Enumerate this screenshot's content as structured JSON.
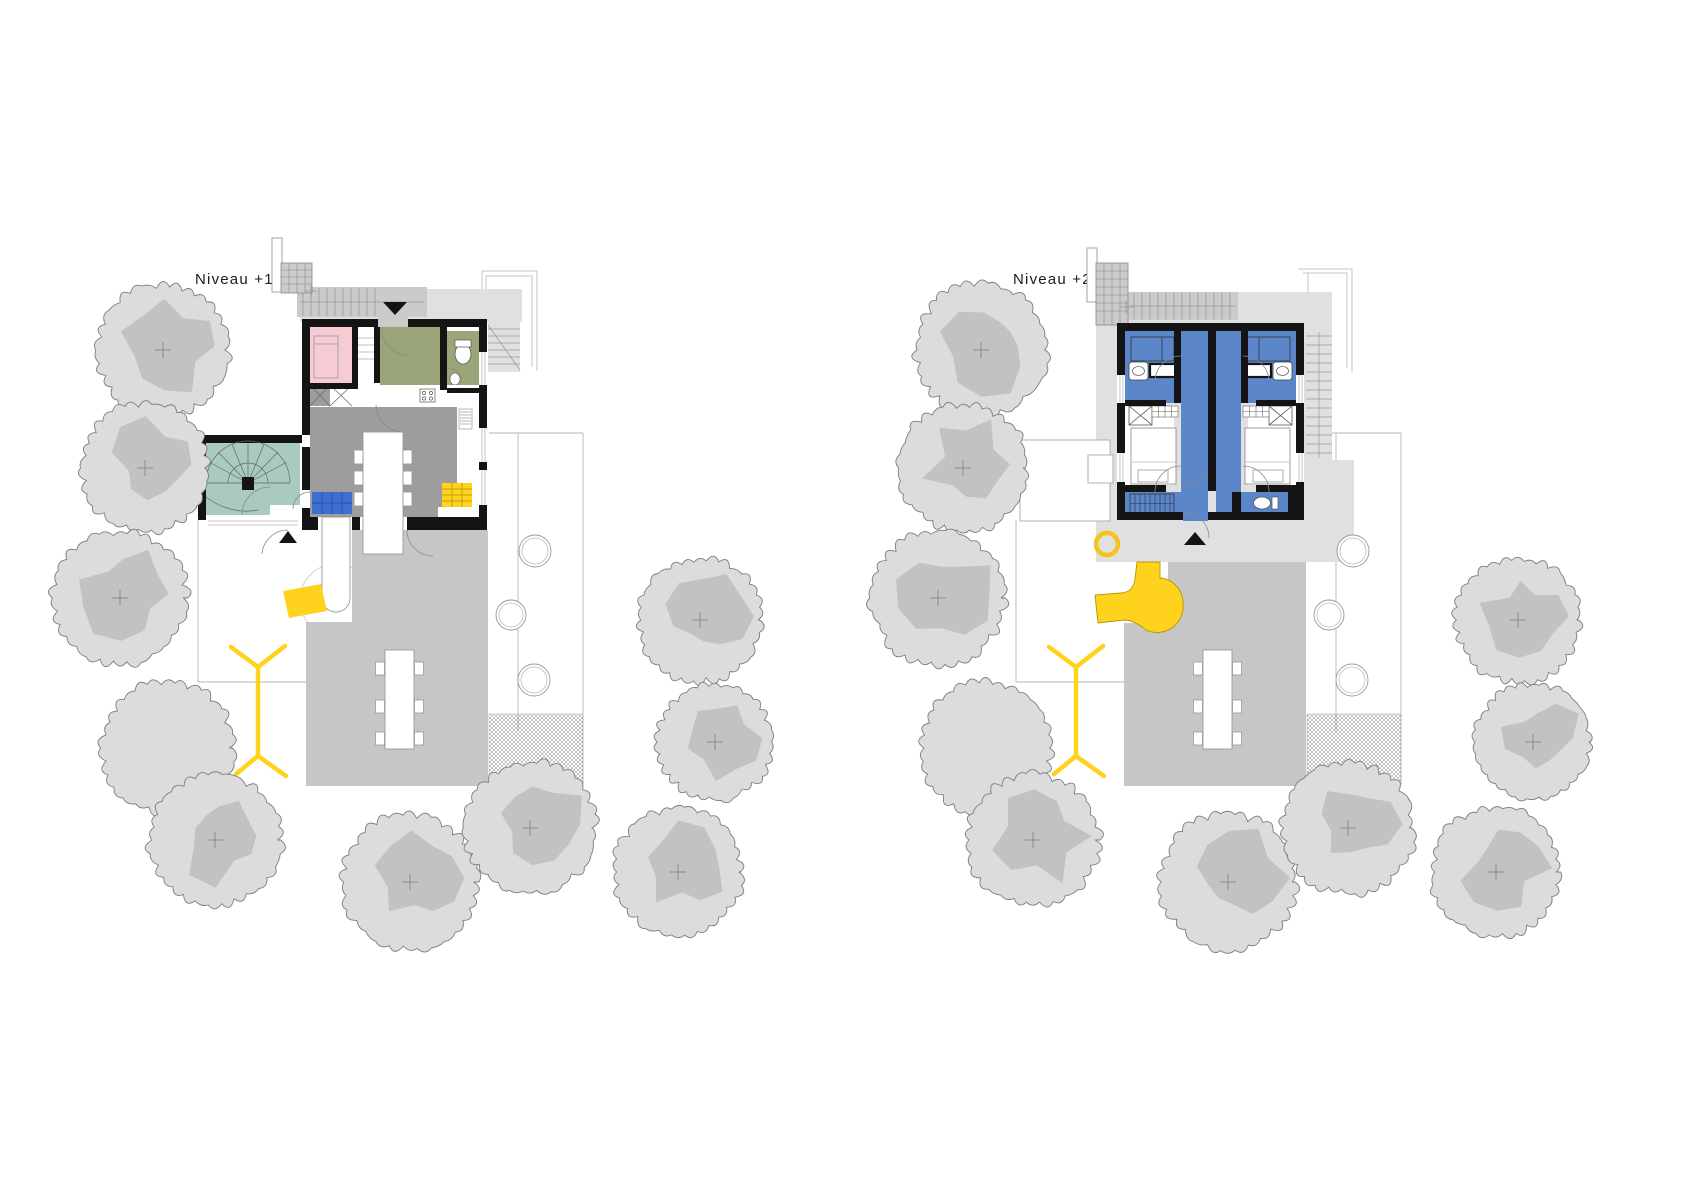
{
  "page": {
    "background": "#ffffff",
    "drawing_type": "architectural site plan, two levels side by side"
  },
  "plans": [
    {
      "label": "Niveau +1",
      "label_x": 195,
      "label_y": 284,
      "offset_x": 0
    },
    {
      "label": "Niveau +2",
      "label_x": 1013,
      "label_y": 284,
      "offset_x": 818
    }
  ],
  "palette": {
    "wall": "#141414",
    "terrace": "#c6c6c6",
    "deck": "#e0e0e1",
    "stair_band": "#cbcbcb",
    "tree_fill": "#dcdcdc",
    "tree_blob": "#c2c2c2",
    "tree_outline": "#7d7d7d",
    "accent_yellow": "#ffd21e",
    "accent_yellow_line": "#b99400",
    "room_pink": "#f6cbd3",
    "room_olive": "#9aa57a",
    "room_teal": "#a8cabf",
    "room_gray": "#9d9d9d",
    "sofa_blue": "#3e6ed2",
    "floor_blue": "#5b86c9"
  },
  "site": {
    "trees": [
      {
        "x": 163,
        "y": 350,
        "r": 66,
        "blob": true
      },
      {
        "x": 145,
        "y": 468,
        "r": 64,
        "blob": true
      },
      {
        "x": 120,
        "y": 598,
        "r": 67,
        "blob": true
      },
      {
        "x": 168,
        "y": 748,
        "r": 66,
        "blob": false
      },
      {
        "x": 215,
        "y": 840,
        "r": 66,
        "blob": true
      },
      {
        "x": 410,
        "y": 882,
        "r": 68,
        "blob": true
      },
      {
        "x": 530,
        "y": 828,
        "r": 66,
        "blob": true
      },
      {
        "x": 678,
        "y": 872,
        "r": 64,
        "blob": true
      },
      {
        "x": 700,
        "y": 620,
        "r": 62,
        "blob": true
      },
      {
        "x": 715,
        "y": 742,
        "r": 58,
        "blob": true
      }
    ],
    "stepping_stones": [
      {
        "x": 535,
        "y": 551,
        "r": 16
      },
      {
        "x": 511,
        "y": 615,
        "r": 15
      },
      {
        "x": 534,
        "y": 680,
        "r": 16
      }
    ],
    "gravel_patch": {
      "x": 489,
      "y": 714,
      "w": 94,
      "h": 70
    },
    "boundary_lines": [
      {
        "x1": 583,
        "y1": 433,
        "x2": 583,
        "y2": 784
      },
      {
        "x1": 489,
        "y1": 433,
        "x2": 583,
        "y2": 433
      },
      {
        "x1": 518,
        "y1": 433,
        "x2": 518,
        "y2": 731
      },
      {
        "x1": 198,
        "y1": 520,
        "x2": 198,
        "y2": 682
      },
      {
        "x1": 198,
        "y1": 682,
        "x2": 306,
        "y2": 682
      }
    ],
    "picnic_table": {
      "x": 385,
      "y": 650,
      "w": 29,
      "h": 99
    },
    "hammock": {
      "top_join": [
        258,
        667
      ],
      "bottom_join": [
        258,
        756
      ],
      "arms": [
        [
          231,
          647
        ],
        [
          285,
          646
        ],
        [
          236,
          774
        ],
        [
          286,
          776
        ]
      ]
    }
  }
}
